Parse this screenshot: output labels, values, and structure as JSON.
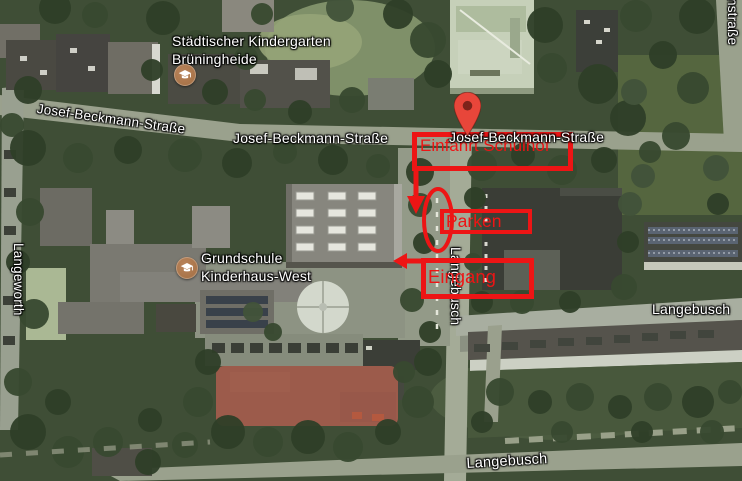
{
  "map": {
    "view": "satellite",
    "streets": {
      "josef_beckmann_left": "Josef-Beckmann-Straße",
      "josef_beckmann_center": "Josef-Beckmann-Straße",
      "josef_beckmann_right": "Josef-Beckmann-Straße",
      "langeworth": "Langeworth",
      "langebusch_vertical": "Langebusch",
      "langebusch_right": "Langebusch",
      "langebusch_bottom": "Langebusch",
      "strasse_partial_right": "nstraße"
    },
    "pois": [
      {
        "line1": "Städtischer Kindergarten",
        "line2": "Brüningheide",
        "icon": "graduation-cap"
      },
      {
        "line1": "Grundschule",
        "line2": "Kinderhaus-West",
        "icon": "graduation-cap"
      }
    ],
    "marker": {
      "type": "location-pin",
      "color": "#e8463a"
    }
  },
  "annotations": {
    "color": "#ed1515",
    "boxes": [
      {
        "label": "Einfahrt Schulhof"
      },
      {
        "label": "Parken"
      },
      {
        "label": "Eingang"
      }
    ],
    "shapes": [
      "down-arrow",
      "left-arrow",
      "parking-ellipse"
    ]
  }
}
